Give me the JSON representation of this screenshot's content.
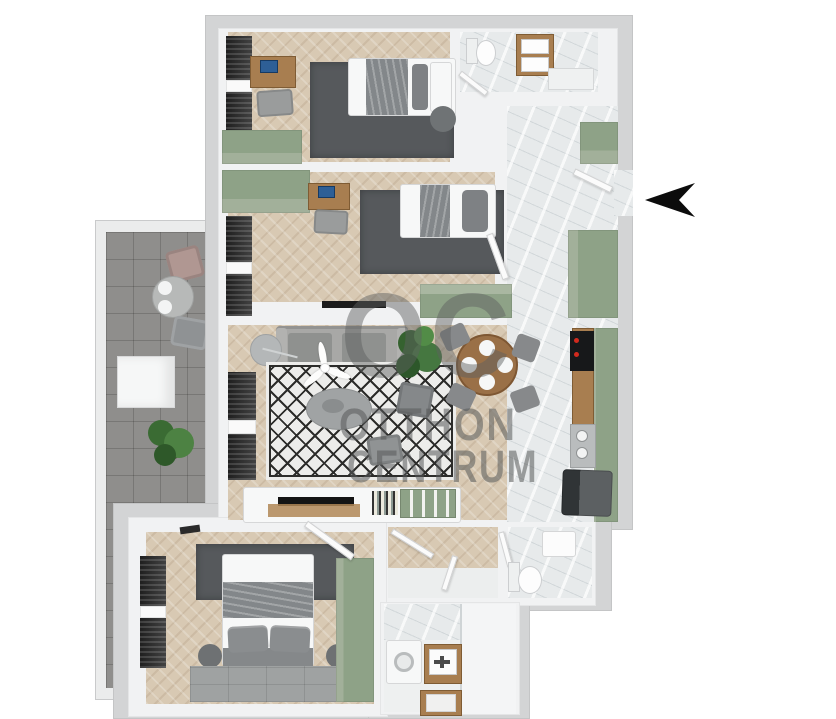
{
  "watermark": {
    "logo": "OC",
    "line1": "OTTHON",
    "line2": "CENTRUM"
  },
  "entrance": {
    "arrow_icon": "left-arrow",
    "arrow_color": "#0c0c0c"
  },
  "palette": {
    "background": "#ffffff",
    "outer_wall_gray": "#d3d4d5",
    "inner_wall_white": "#f1f2f3",
    "wood_floor": "#d8c9b3",
    "marble_floor": "#e7eaeb",
    "balcony_tile": "#8f8e8c",
    "rug_dark": "#56595c",
    "sage_green": "#8ea287",
    "furniture_wood": "#a87e50",
    "sofa_gray": "#a6a6a4",
    "watermark_gray": "#5a5c5c"
  }
}
